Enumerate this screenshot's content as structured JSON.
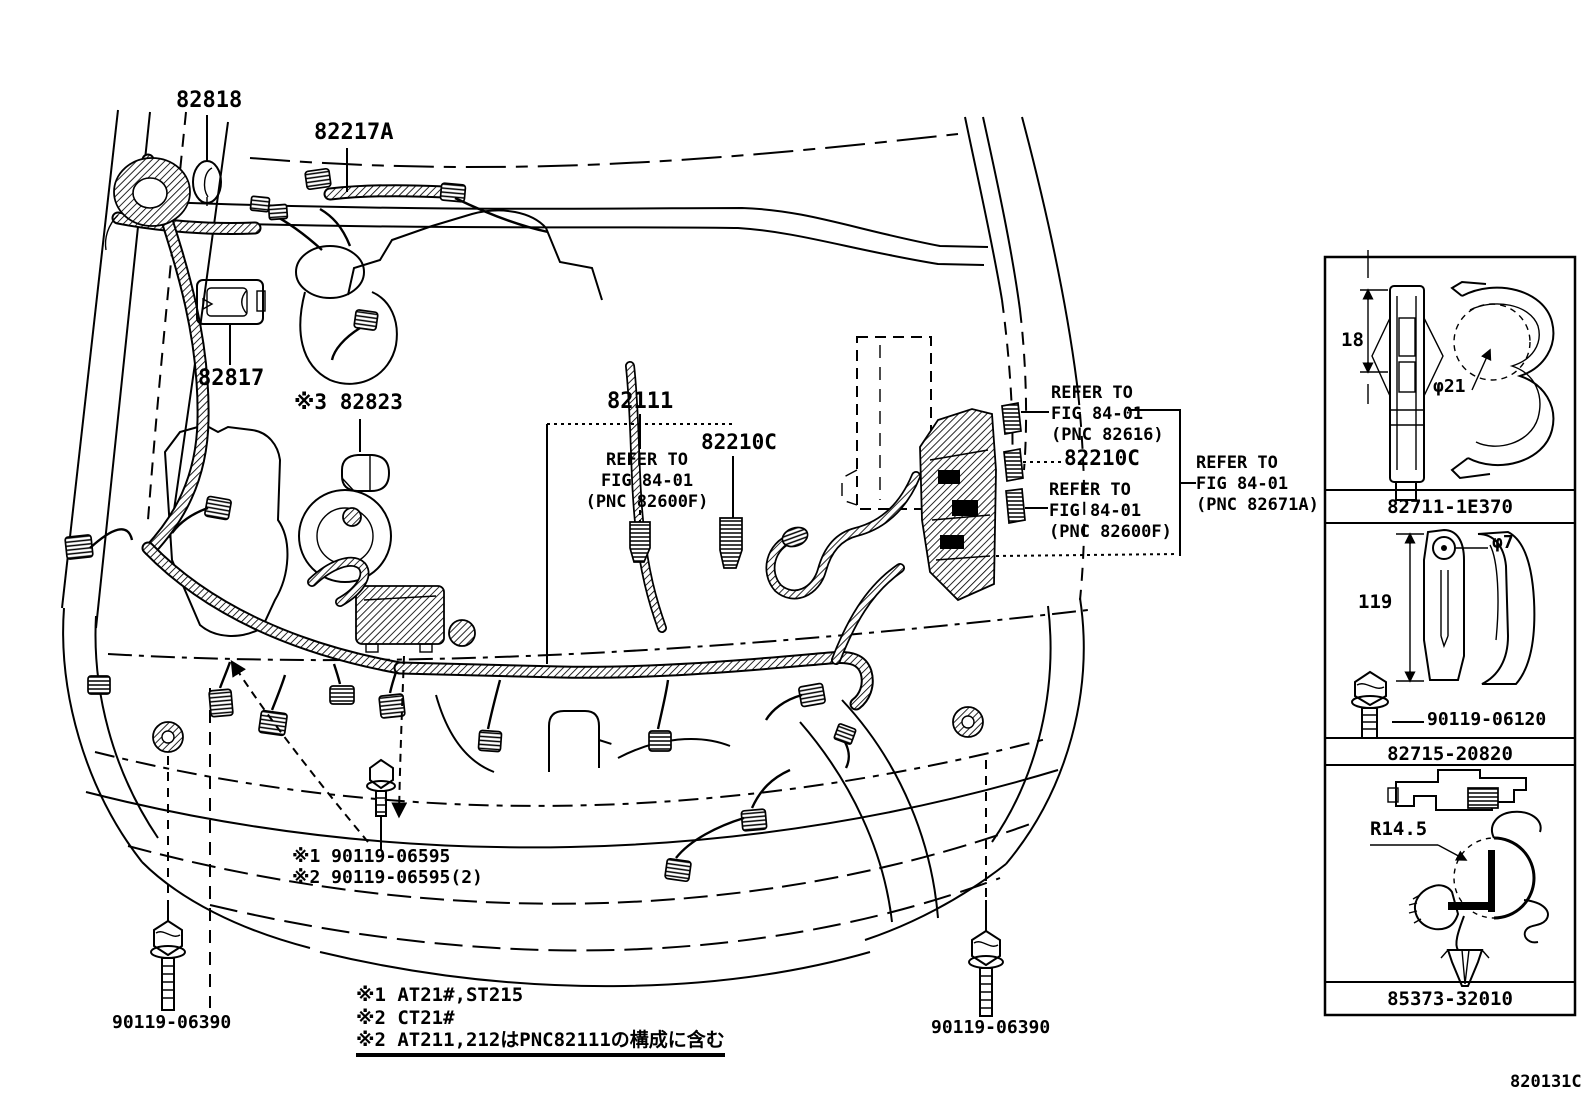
{
  "colors": {
    "ink": "#000000",
    "paper": "#ffffff"
  },
  "drawing_code": "820131C",
  "part_labels": {
    "p82818": "82818",
    "p82217A": "82217A",
    "p82817": "82817",
    "p82823": "※3 82823",
    "p82111": "82111",
    "p82210c_mid": "82210C",
    "p82210c_right": "82210C"
  },
  "refer_notes": {
    "mid_82600f": {
      "line1": "REFER TO",
      "line2": "FIG 84-01",
      "line3": "(PNC 82600F)"
    },
    "right_82616": {
      "line1": "REFER TO",
      "line2": "FIG 84-01",
      "line3": "(PNC 82616)"
    },
    "right_82600f": {
      "line1": "REFER TO",
      "line2": "FIG 84-01",
      "line3": "(PNC 82600F)"
    },
    "right_82671a": {
      "line1": "REFER TO",
      "line2": "FIG 84-01",
      "line3": "(PNC 82671A)"
    }
  },
  "assembly_notes": {
    "n1": "※1 90119-06595",
    "n2": "※2 90119-06595(2)"
  },
  "bolt_labels": {
    "left": "90119-06390",
    "right": "90119-06390"
  },
  "footnotes": {
    "f1": "※1 AT21#,ST215",
    "f2": "※2 CT21#",
    "f3": "※2 AT211,212はPNC82111の構成に含む"
  },
  "side_panel": {
    "cells": [
      {
        "part_no": "82711-1E370",
        "dim1": "18",
        "dim2": "φ21"
      },
      {
        "part_no": "82715-20820",
        "dim1": "119",
        "dim2": "φ7",
        "sub_part": "90119-06120"
      },
      {
        "part_no": "85373-32010",
        "dim1": "R14.5"
      }
    ]
  }
}
